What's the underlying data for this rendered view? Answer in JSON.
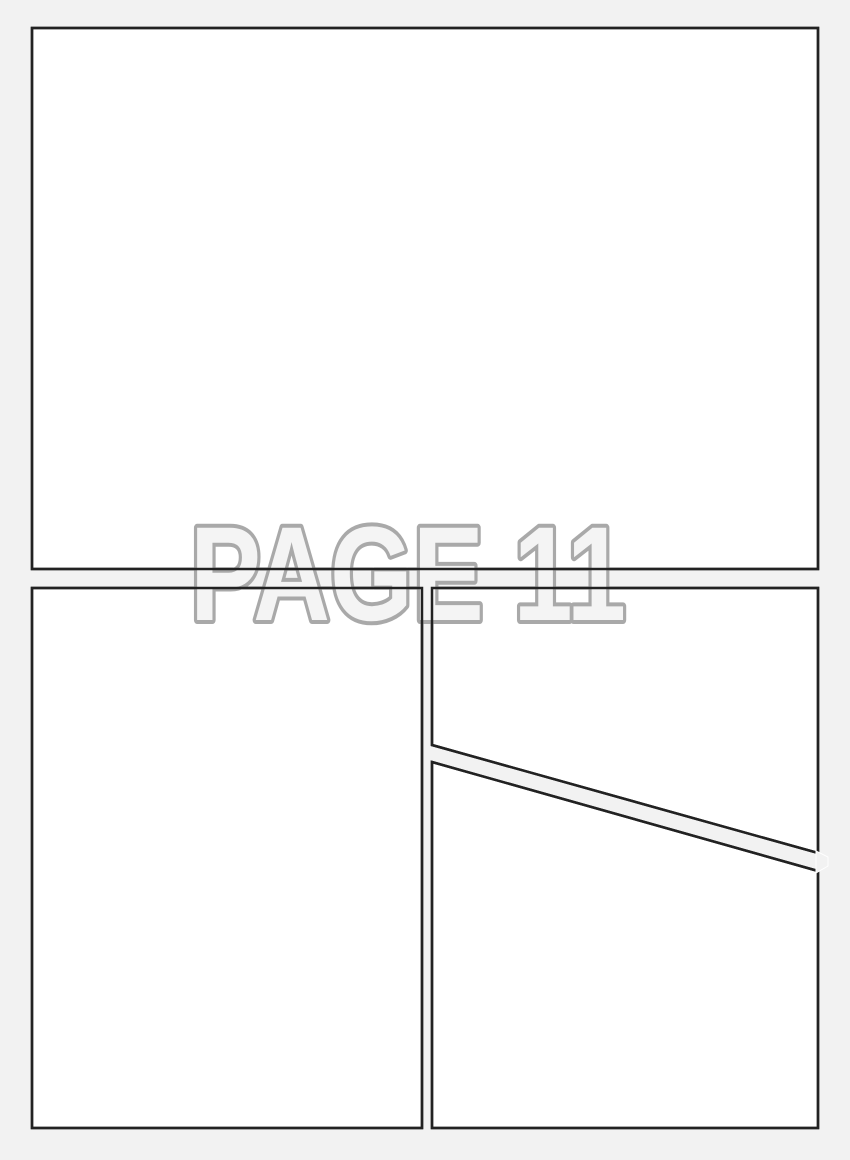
{
  "label": {
    "text": "PAGE 11"
  },
  "colors": {
    "page_background": "#f2f2f2",
    "panel_fill": "#ffffff",
    "panel_border": "#222222",
    "label_fill": "#f4f4f4",
    "label_outline": "#a9a9a9"
  },
  "panels": {
    "count": 4,
    "names": [
      "top-full-width",
      "bottom-left",
      "top-right",
      "bottom-right"
    ]
  }
}
